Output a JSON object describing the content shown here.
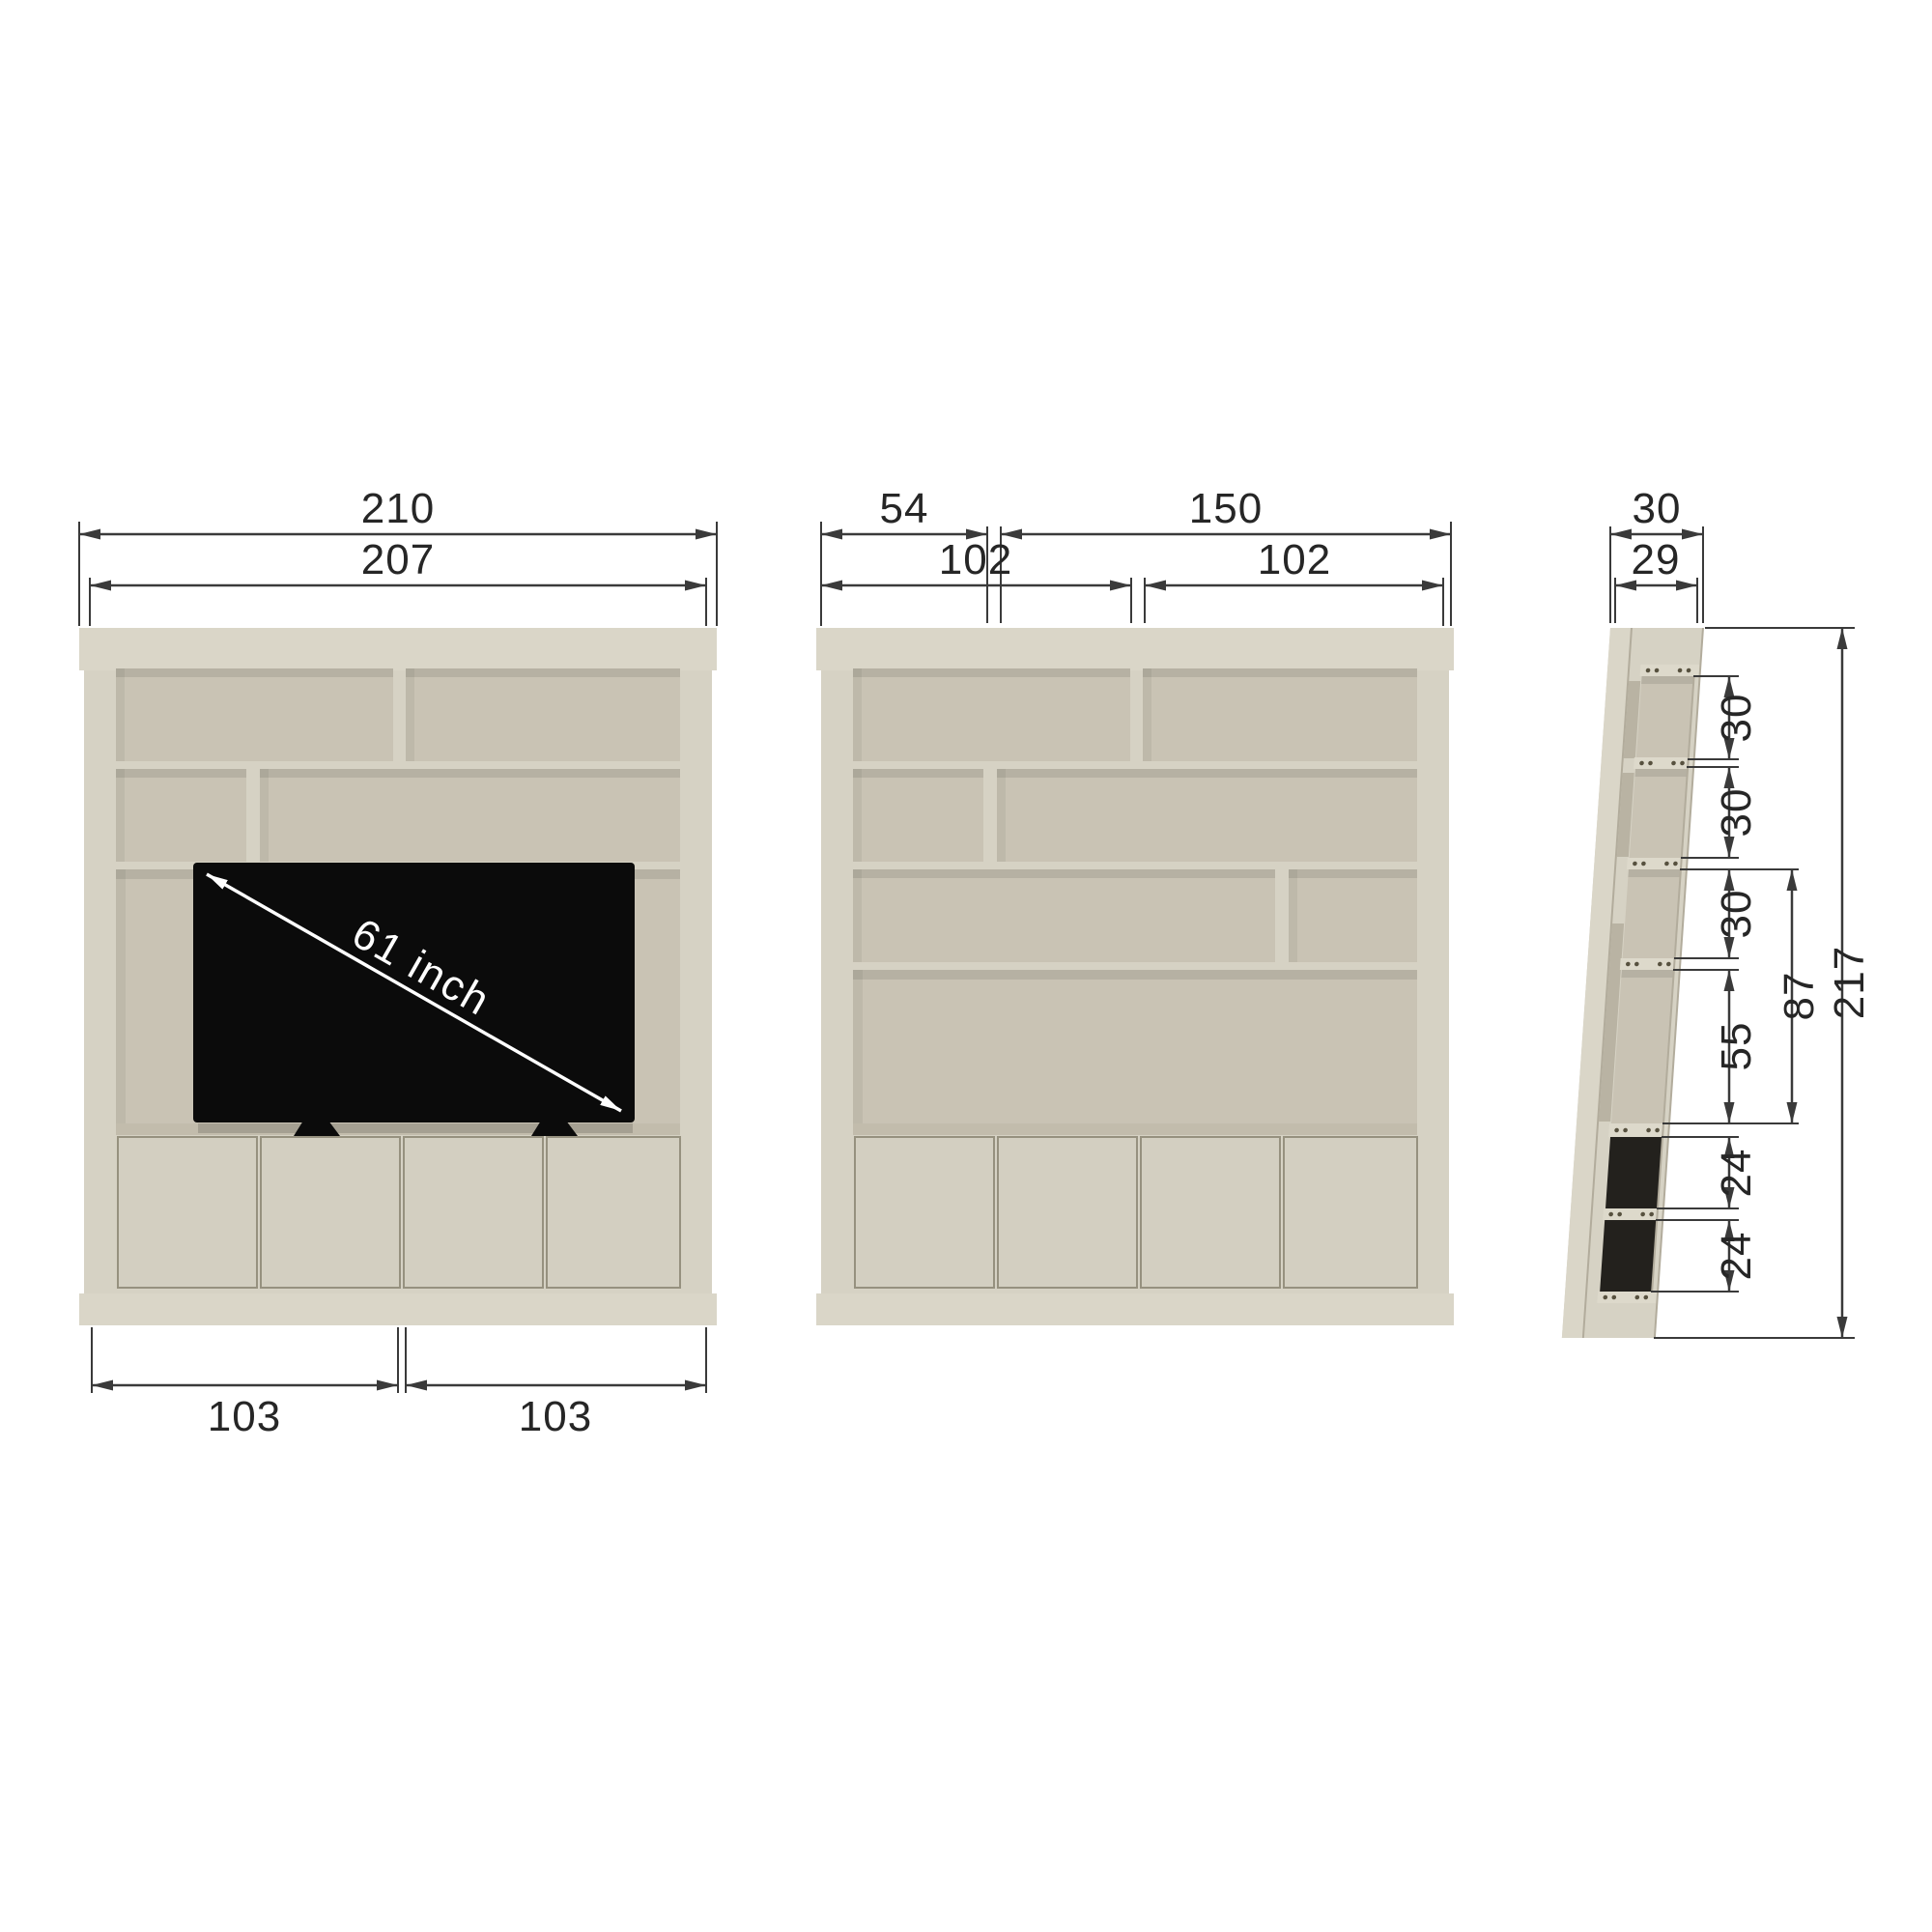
{
  "drawing": {
    "title": "tv-wall-unit-dimension-drawing",
    "front_view_tv": {
      "outer_width": "210",
      "inner_width": "207",
      "door_pair_left": "103",
      "door_pair_right": "103",
      "tv_diagonal": "61 inch"
    },
    "front_view_open": {
      "top_shelf_left": "54",
      "top_shelf_right": "150",
      "doors_left": "102",
      "doors_right": "102"
    },
    "side_view": {
      "depth_outer": "30",
      "depth_inner": "29",
      "row1_height": "30",
      "row2_height": "30",
      "row3_height": "30",
      "open_section_height": "55",
      "tv_opening_height": "87",
      "box1_height": "24",
      "box2_height": "24",
      "total_height": "217"
    },
    "colors": {
      "frame": "#d6d2c4",
      "frame_light": "#dad6c8",
      "panel": "#c9c3b4",
      "shelf_face": "#ddd9cb",
      "door": "#d3cfc1",
      "dark": "#23211d",
      "tv": "#0b0b0b",
      "dim": "#3a3a3a"
    }
  }
}
